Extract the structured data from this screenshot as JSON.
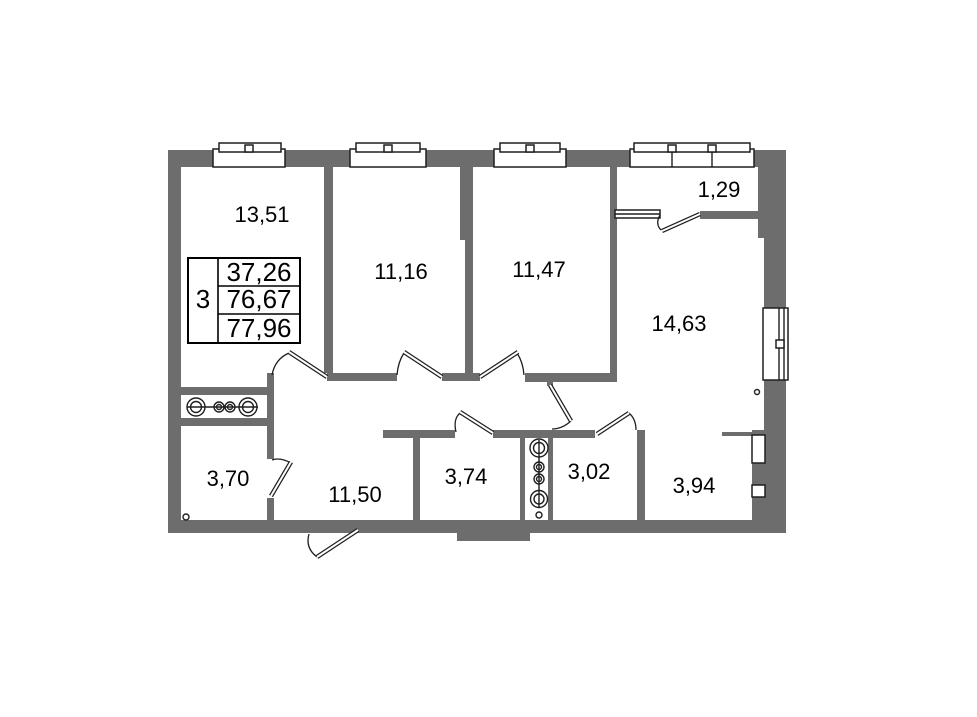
{
  "floorplan": {
    "rooms": [
      {
        "name": "room-top-left",
        "area_label": "13,51"
      },
      {
        "name": "room-top-mid-left",
        "area_label": "11,16"
      },
      {
        "name": "room-top-mid-right",
        "area_label": "11,47"
      },
      {
        "name": "balcony",
        "area_label": "1,29"
      },
      {
        "name": "room-right",
        "area_label": "14,63"
      },
      {
        "name": "bathroom-left",
        "area_label": "3,70"
      },
      {
        "name": "hallway",
        "area_label": "11,50"
      },
      {
        "name": "bathroom-mid",
        "area_label": "3,74"
      },
      {
        "name": "wc",
        "area_label": "3,02"
      },
      {
        "name": "storage-right",
        "area_label": "3,94"
      }
    ],
    "legend_table": {
      "left_cell": "3",
      "rows": [
        "37,26",
        "76,67",
        "77,96"
      ]
    }
  },
  "colors": {
    "wall_fill": "#6d6d6d",
    "line_stroke": "#1f1f1f",
    "label_text": "#000000",
    "background": "#ffffff"
  }
}
